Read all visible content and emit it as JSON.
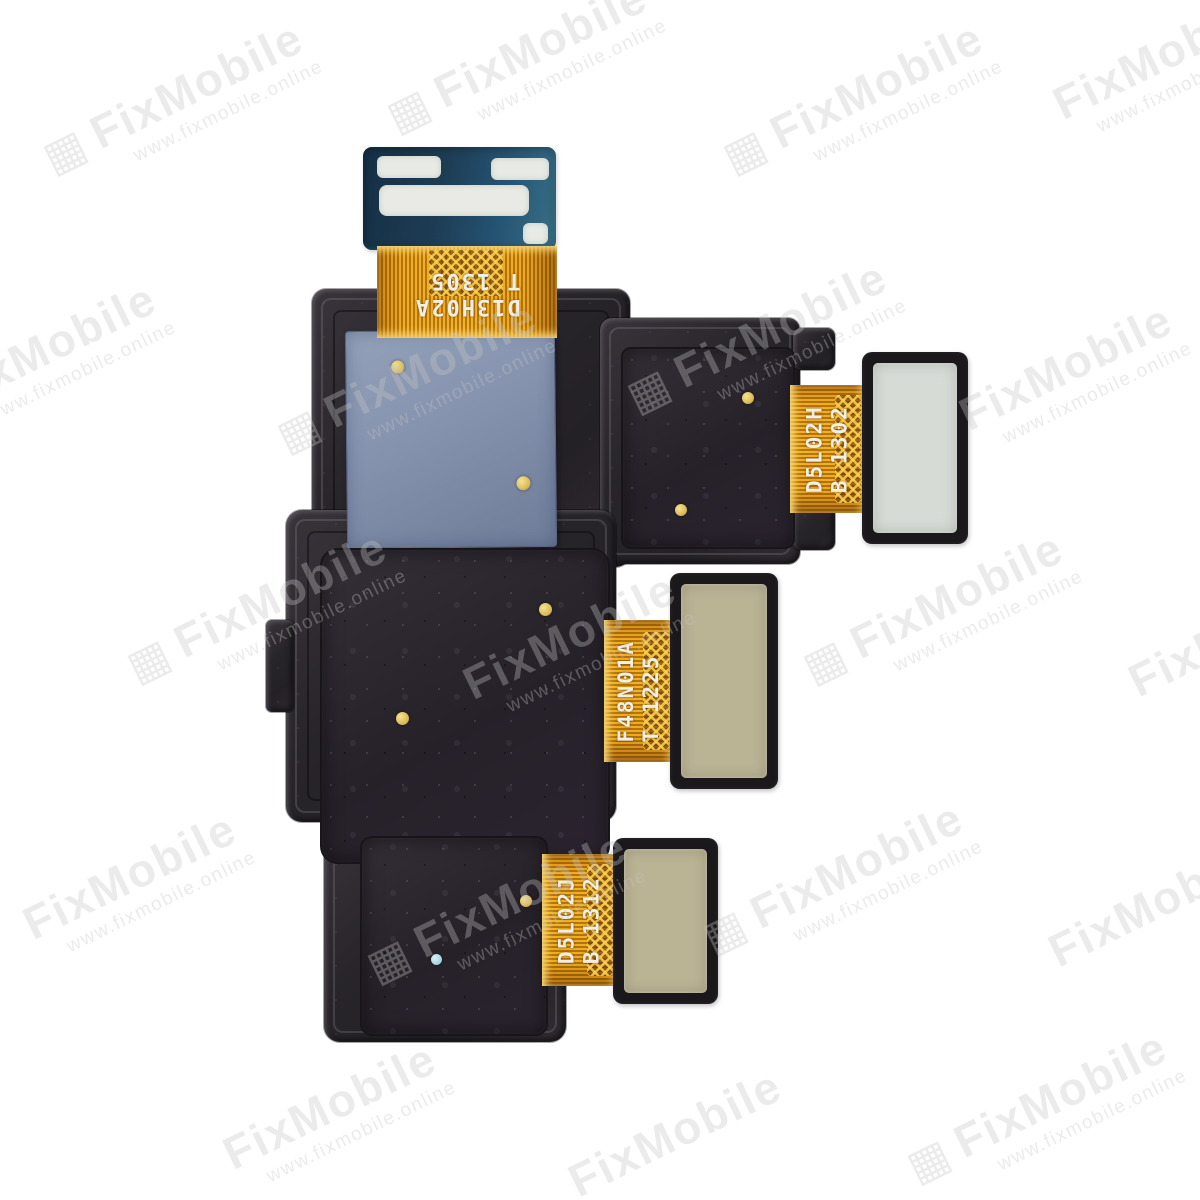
{
  "photo": {
    "subject": "rear-camera-flex-module",
    "background": "#ffffff"
  },
  "watermark": {
    "brand": "FixMobile",
    "url": "www.fixmobile.online",
    "qr_icon": "▦"
  },
  "flex_markings": {
    "top": {
      "line1": "D13H02A",
      "line2": "T 1305"
    },
    "upper_right": {
      "line1": "D5L02H",
      "line2": "B 1302"
    },
    "middle_right": {
      "line1": "F48N01A",
      "line2": "T 1225"
    },
    "bottom": {
      "line1": "D5L02J",
      "line2": "B 1312"
    }
  },
  "colors": {
    "background": "#ffffff",
    "housing": "#2b282b",
    "module": "#272229",
    "flex-orange": "#f2ad1c",
    "flex-deep": "#a96605",
    "flex-bright": "#ffe07d",
    "pcb-teal": "#1d3c54",
    "pcb-teal-light": "#387087",
    "pad-white": "#e9eae5",
    "pad-silver": "#d7dbd6",
    "pad-khaki": "#bab394",
    "sticker-blue": "#8592ae",
    "sticker-blue-deep": "#6e7c98",
    "gold-dot": "#d9b855",
    "cyan-dot": "#9fd0d8",
    "label-text": "#f3efe4",
    "watermark-gray": "#c6c6c6"
  }
}
